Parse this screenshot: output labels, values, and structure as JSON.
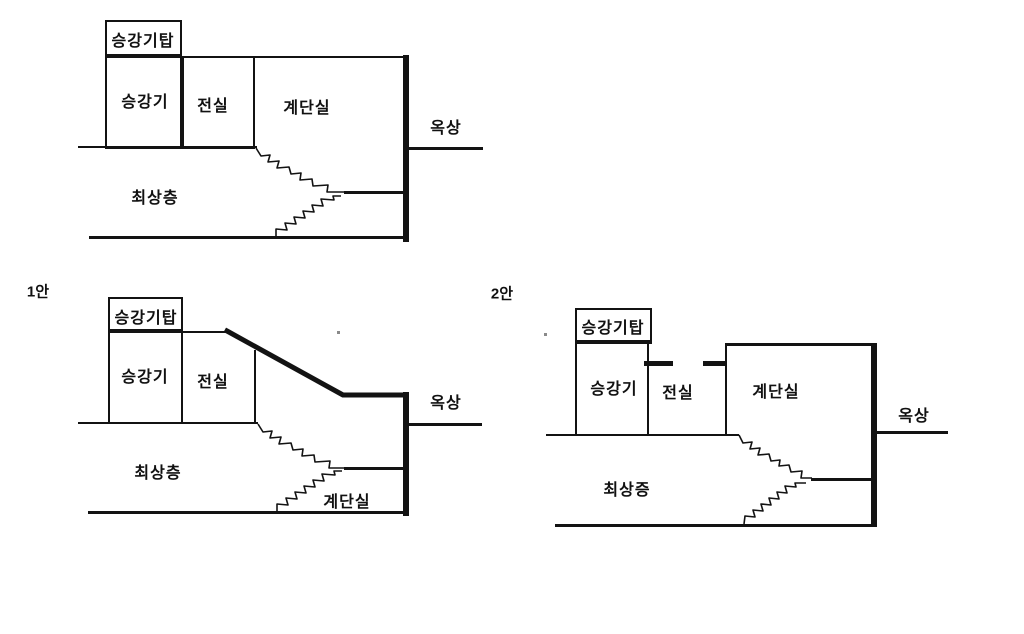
{
  "colors": {
    "line": "#131313",
    "text": "#111111",
    "background": "#ffffff"
  },
  "diagrams": {
    "base": {
      "tower": "승강기탑",
      "elevator": "승강기",
      "vestibule": "전실",
      "stairwell": "계단실",
      "rooftop": "옥상",
      "top_floor": "최상층"
    },
    "plan1": {
      "label": "1안",
      "tower": "승강기탑",
      "elevator": "승강기",
      "vestibule": "전실",
      "stairwell": "계단실",
      "rooftop": "옥상",
      "top_floor": "최상층"
    },
    "plan2": {
      "label": "2안",
      "tower": "승강기탑",
      "elevator": "승강기",
      "vestibule": "전실",
      "stairwell": "계단실",
      "rooftop": "옥상",
      "top_floor": "최상증"
    }
  }
}
